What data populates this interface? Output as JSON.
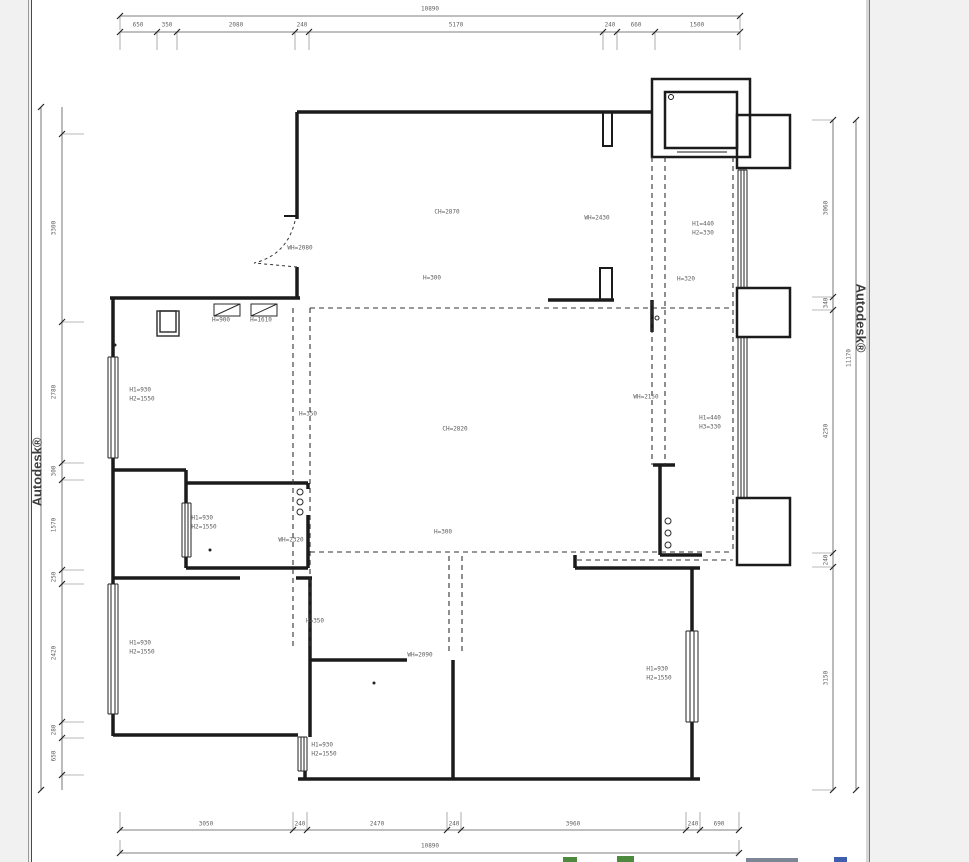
{
  "app": {
    "watermark": "Autodesk®"
  },
  "colors": {
    "page_background": "#f1f1f1",
    "canvas_background": "#ffffff",
    "wall_line": "#1b1b1b",
    "dashed_line": "#333333",
    "dimension_line": "#555555",
    "dimension_text": "#636363",
    "watermark_text": "#3d3d3d",
    "fragment_green": "#4d8a3d",
    "fragment_blue": "#3f5fae"
  },
  "dimensions": {
    "top": {
      "total": "10890",
      "segments": [
        "650",
        "350",
        "2080",
        "240",
        "5170",
        "240",
        "660",
        "1500"
      ]
    },
    "bottom": {
      "total": "10890",
      "segments": [
        "3050",
        "240",
        "2470",
        "240",
        "3960",
        "240",
        "690"
      ]
    },
    "left": {
      "segments": [
        "3300",
        "2780",
        "300",
        "1570",
        "250",
        "2420",
        "280",
        "650"
      ]
    },
    "right": {
      "total": "11170",
      "segments": [
        "3060",
        "340",
        "4250",
        "240",
        "3150"
      ]
    }
  },
  "plan": {
    "labels": [
      "CH=2870",
      "WH=2080",
      "WH=2430",
      "H1=440\nH2=330",
      "H=300",
      "H=320",
      "H=900",
      "H=1610",
      "H1=930\nH2=1550",
      "H=350",
      "CH=2820",
      "WH=2150",
      "H1=440\nH3=330",
      "H=300",
      "WH=2320",
      "H1=930\nH2=1550",
      "H=350",
      "WH=2090",
      "H1=930\nH2=1550",
      "H1=930\nH2=1550",
      "H1=930\nH2=1550"
    ]
  }
}
